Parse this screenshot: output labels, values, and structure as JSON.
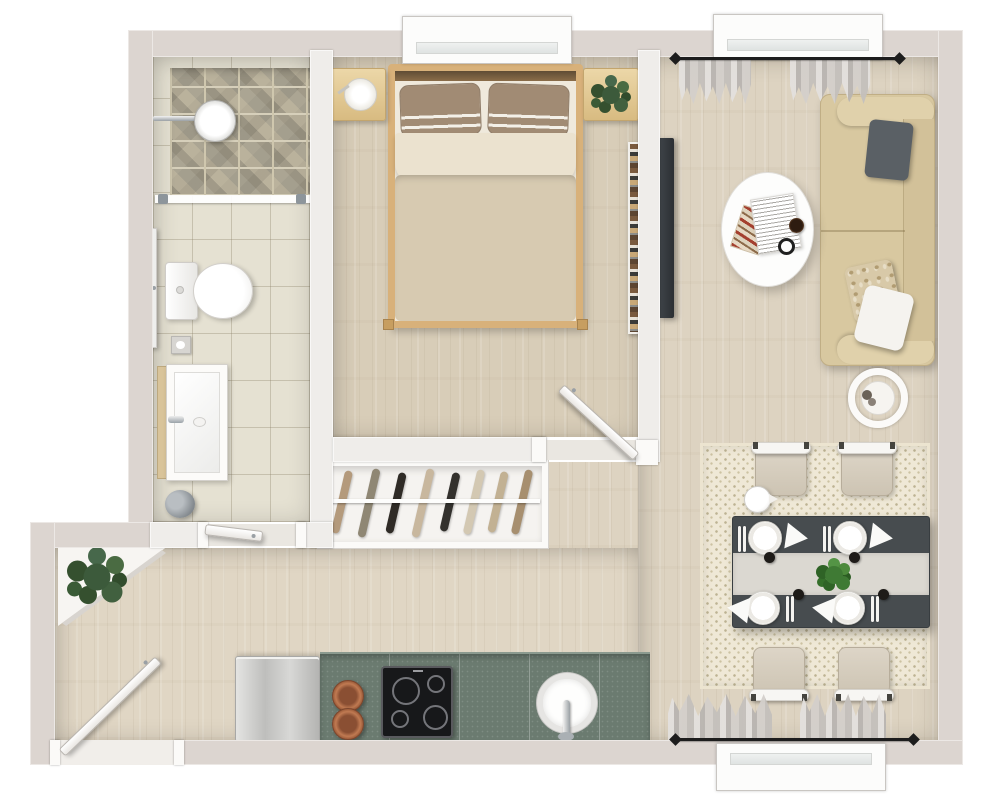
{
  "title": "apartment-floor-plan-3d-top-view",
  "visible_text": [],
  "colors": {
    "wall_exterior": "#dcd5d0",
    "wall_interior": "#efedea",
    "floor_wood": "#ddd3c1",
    "tile_bathroom": "#e5e1d2",
    "stone_shower": "#b7b09d",
    "counter_green": "#6b7b70",
    "fridge_steel": "#c9c9c7",
    "cooktop_black": "#17181a",
    "copper_pan": "#b5714c",
    "bed_frame_wood": "#d8b17a",
    "duvet_beige": "#d7cab1",
    "pillow_taupe": "#a18b74",
    "sofa_beige": "#d8c8a0",
    "cushion_gray": "#5a6065",
    "dining_table_dark": "#474c4f",
    "table_runner": "#dbd8d1",
    "rug_cream": "#efe8d6",
    "plant_green": "#3c5a3b",
    "curtain_gray": "#c6c3c0",
    "rod_black": "#1d1d1d"
  },
  "floorplan": {
    "style": "rendered top-down apartment plan, no text labels",
    "rooms": [
      {
        "name": "bathroom",
        "items": [
          "walk-in-shower with stone floor",
          "shower-head",
          "glass-partition",
          "toilet",
          "toilet-paper-holder",
          "vanity-sink with wood panel",
          "wall-cabinet",
          "waste-bin",
          "interior-door"
        ]
      },
      {
        "name": "bedroom",
        "items": [
          "double-bed",
          "2 striped pillows",
          "duvet",
          "nightstand with lamp",
          "nightstand with plant",
          "window",
          "bookshelf",
          "interior-door"
        ]
      },
      {
        "name": "closet",
        "items": [
          "open-wardrobe",
          "clothes-rail",
          "8 hangers with clothes"
        ]
      },
      {
        "name": "hallway-entry",
        "items": [
          "entry-door",
          "corner-shelf",
          "potted-plant"
        ]
      },
      {
        "name": "kitchen",
        "items": [
          "refrigerator",
          "green-countertop",
          "2 copper pans",
          "induction-cooktop with 4 burners",
          "round-sink",
          "faucet",
          "white plinth"
        ]
      },
      {
        "name": "living-room",
        "items": [
          "three-seat sofa",
          "gray cushion",
          "floral cushion",
          "white cushion",
          "oval coffee-table",
          "newspaper",
          "magazine",
          "coffee-cup",
          "alarm-clock",
          "round side-table",
          "wall-mounted tv",
          "window with curtains and black rod"
        ]
      },
      {
        "name": "dining-area",
        "items": [
          "patterned rug",
          "dark dining-table",
          "light table-runner",
          "4 chairs",
          "4 plates",
          "4 napkins",
          "cutlery",
          "4 black cups",
          "herb centerpiece",
          "teapot",
          "window with curtains and black rod"
        ]
      }
    ],
    "counts": {
      "windows": 3,
      "doors": 4,
      "chairs": 4,
      "plates": 4,
      "hangers": 8,
      "copper_pans": 2,
      "bed_pillows": 2,
      "sofa_cushions": 3
    }
  }
}
